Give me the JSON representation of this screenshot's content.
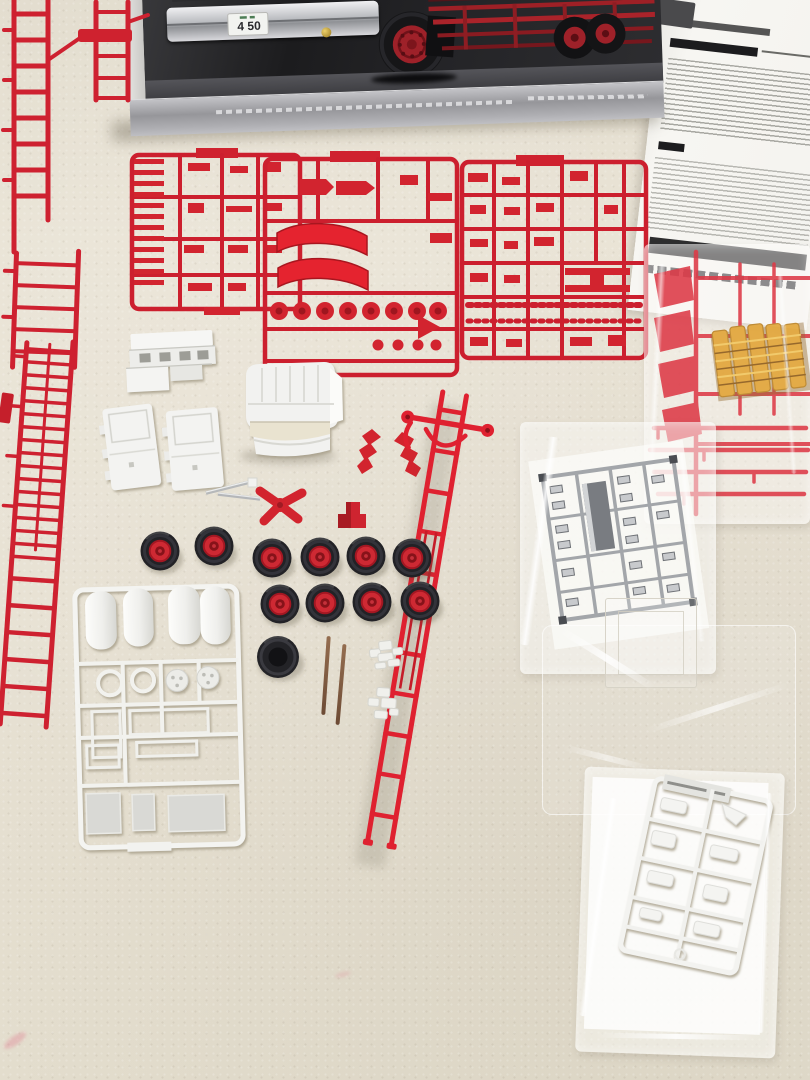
{
  "scene": {
    "subject": "Unassembled Japanese fire ladder-truck plastic model kit spread out on a beige leatherette table",
    "surface_color": "#e6e0d2"
  },
  "kit_box": {
    "art": "low front view of a red and chrome cab-over fire truck on black background",
    "license_plate": "4 50",
    "colors": {
      "photo_background": "#1c1c1e",
      "silver_band": "#a0a0a4",
      "side_edge": "#d6d5d2",
      "chrome_bumper": "#c6c8cc",
      "hub_red": "#9e2129"
    }
  },
  "instruction_sheet": {
    "name": "folded-instruction-sheet",
    "paper_color": "#f6f5f1",
    "print": "dense japanese text, not legible at this scale"
  },
  "sprues": {
    "red_color": "#d2222f",
    "items": [
      {
        "name": "chassis-rail-runner"
      },
      {
        "name": "ladder-section-runner"
      },
      {
        "name": "grille-parts-sprue"
      },
      {
        "name": "fender-parts-sprue"
      },
      {
        "name": "detail-parts-sprue"
      }
    ]
  },
  "white_parts": {
    "plastic_color": "#f3f3f1",
    "items": [
      {
        "name": "cab-shell"
      },
      {
        "name": "front-panel"
      },
      {
        "name": "door-panel-left"
      },
      {
        "name": "door-panel-right"
      },
      {
        "name": "tank-parts-sprue"
      },
      {
        "name": "small-clear-part-clusters"
      }
    ]
  },
  "wheels": {
    "count": 10,
    "tire_color": "#232327",
    "hub_color": "#cf2933",
    "spare_tires": 1
  },
  "axle_rods": {
    "count": 2,
    "color": "#7d5a41"
  },
  "aerial_ladder": {
    "name": "aerial-ladder",
    "color": "#df2130"
  },
  "bags": [
    {
      "name": "bag-chrome-sprue",
      "content": "chrome plated parts sprue"
    },
    {
      "name": "bag-red-amber-sprue",
      "content": "red mudguard sprue with amber light parts"
    },
    {
      "name": "bag-clear-parts",
      "content": "clear window part in empty bag"
    },
    {
      "name": "bag-white-sprue",
      "content": "white detail parts sprue on paper"
    }
  ]
}
